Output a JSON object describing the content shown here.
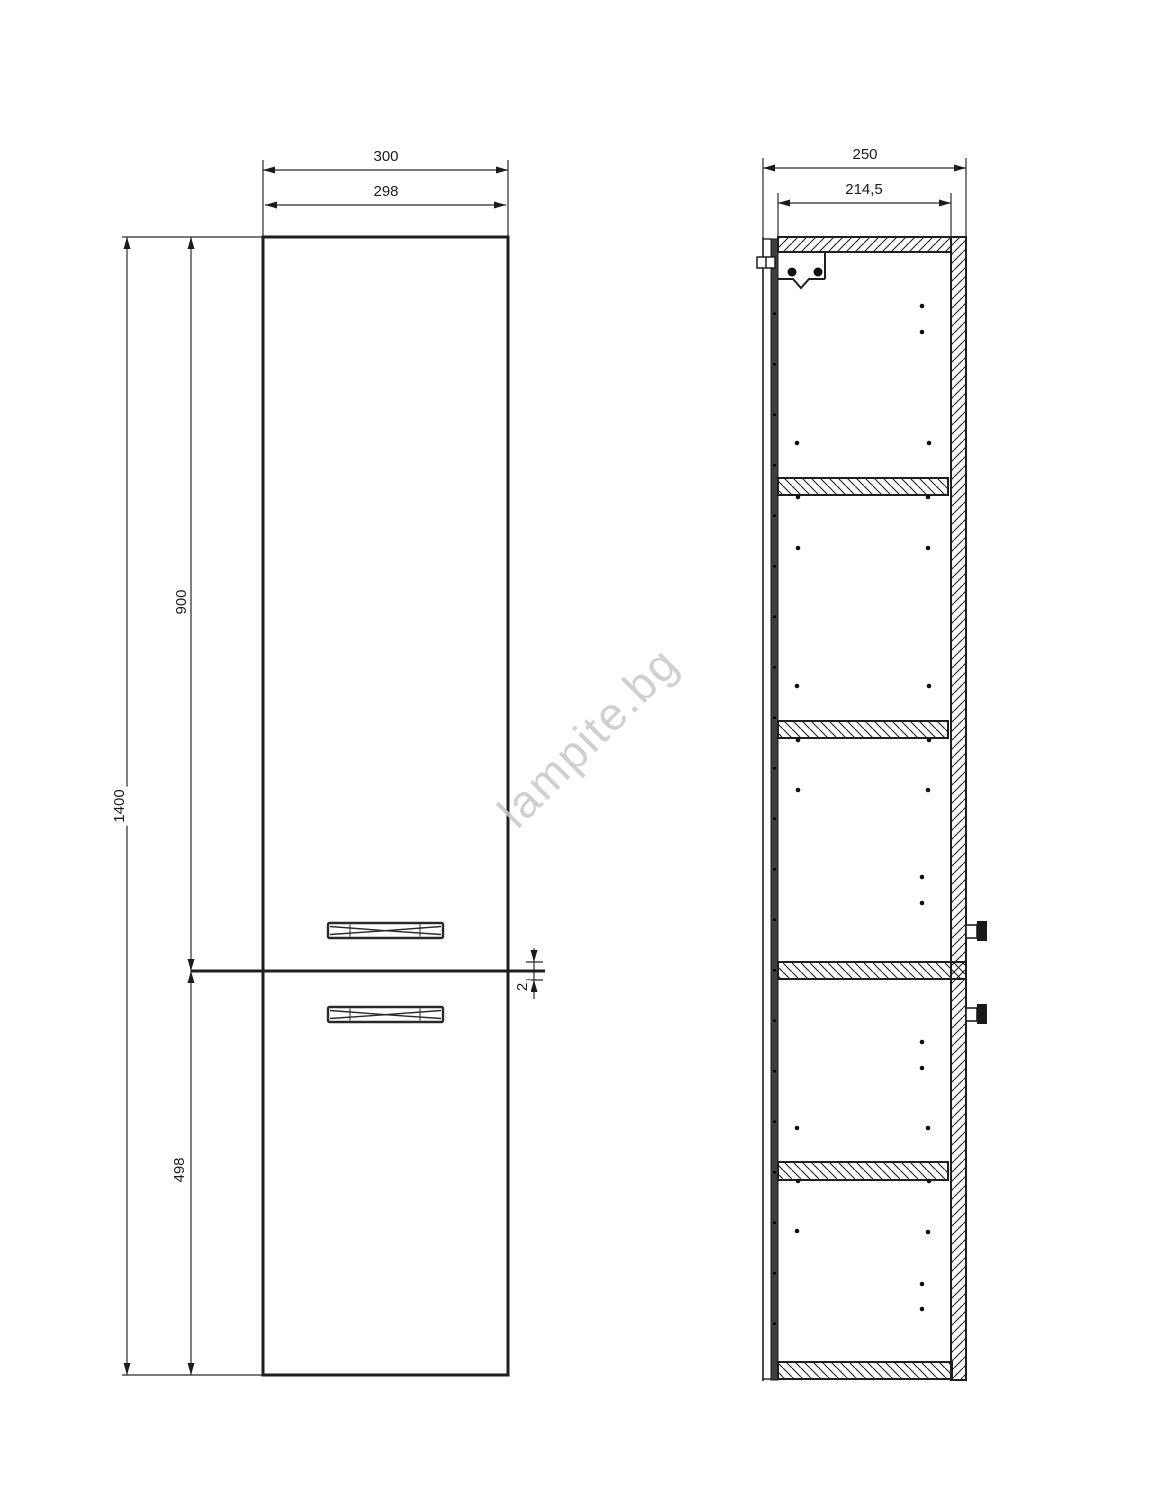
{
  "watermark": {
    "text": "lampite.bg"
  },
  "front_view": {
    "title": "cabinet front view",
    "dims": {
      "overall_width": "300",
      "door_width": "298",
      "overall_height": "1400",
      "upper_door_height": "900",
      "lower_door_height": "498",
      "door_gap": "2"
    }
  },
  "side_view": {
    "title": "cabinet side section view",
    "dims": {
      "overall_depth": "250",
      "inner_depth": "214,5"
    }
  },
  "colors": {
    "line": "#1f1f1f",
    "dim_line": "#2a2a2a",
    "door_strip": "#3e3e3e",
    "watermark": "#c8c8c8",
    "background": "#ffffff"
  }
}
